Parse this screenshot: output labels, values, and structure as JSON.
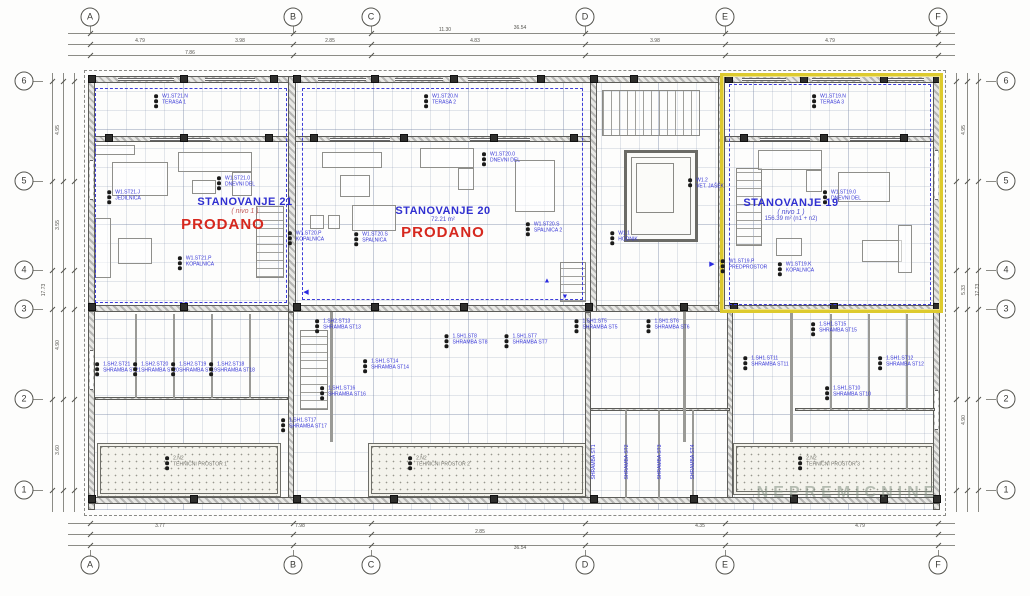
{
  "meta": {
    "watermark": "NEPREMICNINE"
  },
  "colors": {
    "blue": "#3434d6",
    "red": "#d6281e",
    "gray": "#76766e",
    "dim": "#55544e",
    "yellow": "#ddca2e"
  },
  "grid": {
    "columns": [
      {
        "label": "A",
        "x": 90
      },
      {
        "label": "B",
        "x": 293
      },
      {
        "label": "C",
        "x": 371
      },
      {
        "label": "D",
        "x": 585
      },
      {
        "label": "E",
        "x": 725
      },
      {
        "label": "F",
        "x": 938
      }
    ],
    "rows": [
      {
        "label": "6",
        "y": 81
      },
      {
        "label": "5",
        "y": 181
      },
      {
        "label": "4",
        "y": 270
      },
      {
        "label": "3",
        "y": 309
      },
      {
        "label": "2",
        "y": 399
      },
      {
        "label": "1",
        "y": 490
      }
    ]
  },
  "apartments": [
    {
      "name": "STANOVANJE 21",
      "level": "( nivo 1 )",
      "status": "PRODANO"
    },
    {
      "name": "STANOVANJE 20",
      "area": "72.21 m²",
      "status": "PRODANO"
    },
    {
      "name": "STANOVANJE 19",
      "level": "( nivo 1 )",
      "area": "156.39 m² (n1 + n2)"
    }
  ],
  "annotations": [
    [
      175,
      100,
      "W1.ST21.N|TERASA 1",
      "blue",
      5,
      0,
      3
    ],
    [
      445,
      100,
      "W1.ST20.N|TERASA 2",
      "blue",
      5,
      0,
      3
    ],
    [
      833,
      100,
      "W1.ST19.N|TERASA 3",
      "blue",
      5,
      0,
      3
    ],
    [
      240,
      182,
      "W1.ST21.0|DNEVNI DEL",
      "blue",
      5,
      0,
      3
    ],
    [
      128,
      196,
      "W1.ST21.J|JEDILNICA",
      "blue",
      5,
      0,
      3
    ],
    [
      505,
      158,
      "W1.ST20.0|DNEVNI DEL",
      "blue",
      5,
      0,
      3
    ],
    [
      846,
      196,
      "W1.ST19.0|DNEVNI DEL",
      "blue",
      5,
      0,
      3
    ],
    [
      200,
      262,
      "W1.ST21.P|KOPALNICA",
      "blue",
      5,
      0,
      3
    ],
    [
      310,
      237,
      "W1.ST20.P|KOPALNICA",
      "blue",
      5,
      0,
      3
    ],
    [
      375,
      238,
      "W1.ST20.S|SPALNICA",
      "blue",
      5,
      0,
      3
    ],
    [
      548,
      228,
      "W1.ST20.S|SPALNICA 2",
      "blue",
      5,
      0,
      3
    ],
    [
      748,
      265,
      "W1.ST19.P|PREDPROSTOR",
      "blue",
      5,
      0,
      3
    ],
    [
      800,
      268,
      "W1.ST19.K|KOPALNICA",
      "blue",
      5,
      0,
      3
    ],
    [
      628,
      237,
      "W1.1|HODNIK",
      "blue",
      5,
      0,
      3
    ],
    [
      710,
      184,
      "W1.2|VET. JAŠEK",
      "blue",
      5,
      0,
      2
    ],
    [
      122,
      368,
      "1.SH2.ST21|SHRAMBA ST21",
      "blue",
      5,
      0,
      3
    ],
    [
      160,
      368,
      "1.SH2.ST20|SHRAMBA ST20",
      "blue",
      5,
      0,
      3
    ],
    [
      198,
      368,
      "1.SH2.ST19|SHRAMBA ST19",
      "blue",
      5,
      0,
      3
    ],
    [
      236,
      368,
      "1.SH2.ST18|SHRAMBA ST18",
      "blue",
      5,
      0,
      3
    ],
    [
      342,
      325,
      "1.SH2.ST13|SHRAMBA ST13",
      "blue",
      5,
      0,
      3
    ],
    [
      390,
      365,
      "1.SH1.ST14|SHRAMBA ST14",
      "blue",
      5,
      0,
      3
    ],
    [
      347,
      392,
      "1.SH1.ST16|SHRAMBA ST16",
      "blue",
      5,
      0,
      3
    ],
    [
      308,
      424,
      "1.SH1.ST17|SHRAMBA ST17",
      "blue",
      5,
      0,
      3
    ],
    [
      470,
      340,
      "1.SH1.ST8|SHRAMBA ST8",
      "blue",
      5,
      0,
      3
    ],
    [
      530,
      340,
      "1.SH1.ST7|SHRAMBA ST7",
      "blue",
      5,
      0,
      3
    ],
    [
      600,
      325,
      "1.SH1.ST5|SHRAMBA ST5",
      "blue",
      5,
      0,
      3
    ],
    [
      672,
      325,
      "1.SH1.ST6|SHRAMBA ST6",
      "blue",
      5,
      0,
      3
    ],
    [
      595,
      462,
      "SHRAMBA ST1",
      "blue",
      5,
      -90,
      0
    ],
    [
      628,
      462,
      "SHRAMBA ST2",
      "blue",
      5,
      -90,
      0
    ],
    [
      661,
      462,
      "SHRAMBA ST3",
      "blue",
      5,
      -90,
      0
    ],
    [
      694,
      462,
      "SHRAMBA ST4",
      "blue",
      5,
      -90,
      0
    ],
    [
      838,
      328,
      "1.SH1.ST15|SHRAMBA ST15",
      "blue",
      5,
      0,
      3
    ],
    [
      770,
      362,
      "1.SH1.ST11|SHRAMBA ST11",
      "blue",
      5,
      0,
      3
    ],
    [
      905,
      362,
      "1.SH1.ST12|SHRAMBA ST12",
      "blue",
      5,
      0,
      3
    ],
    [
      852,
      392,
      "1.SH1.ST10|SHRAMBA ST10",
      "blue",
      5,
      0,
      3
    ],
    [
      200,
      462,
      "2.N2|TEHNIČNI PROSTOR 1",
      "gray",
      5,
      0,
      3
    ],
    [
      443,
      462,
      "2.N2|TEHNIČNI PROSTOR 2",
      "gray",
      5,
      0,
      3
    ],
    [
      833,
      462,
      "2.N2|TEHNIČNI PROSTOR 3",
      "gray",
      5,
      0,
      3
    ]
  ],
  "dimensions": [
    [
      140,
      41,
      "4.79",
      0
    ],
    [
      240,
      41,
      "3.98",
      0
    ],
    [
      330,
      41,
      "2.85",
      0
    ],
    [
      475,
      41,
      "4.83",
      0
    ],
    [
      655,
      41,
      "3.98",
      0
    ],
    [
      830,
      41,
      "4.79",
      0
    ],
    [
      190,
      53,
      "7.86",
      0
    ],
    [
      445,
      30,
      "11.30",
      0
    ],
    [
      520,
      28,
      "36.54",
      0
    ],
    [
      160,
      526,
      "3.77",
      0
    ],
    [
      300,
      526,
      "7.98",
      0
    ],
    [
      480,
      532,
      "2.85",
      0
    ],
    [
      700,
      526,
      "4.35",
      0
    ],
    [
      860,
      526,
      "4.79",
      0
    ],
    [
      520,
      548,
      "36.54",
      0
    ],
    [
      58,
      130,
      "4.95",
      -90
    ],
    [
      58,
      225,
      "3.55",
      -90
    ],
    [
      58,
      345,
      "4.90",
      -90
    ],
    [
      58,
      450,
      "3.60",
      -90
    ],
    [
      44,
      290,
      "17.73",
      -90
    ],
    [
      964,
      130,
      "4.95",
      -90
    ],
    [
      964,
      290,
      "5.33",
      -90
    ],
    [
      964,
      420,
      "4.90",
      -90
    ],
    [
      978,
      290,
      "17.73",
      -90
    ]
  ],
  "arrows": [
    [
      306,
      292,
      "◀"
    ],
    [
      547,
      281,
      "▲"
    ],
    [
      712,
      264,
      "▶"
    ],
    [
      565,
      297,
      "▼"
    ]
  ]
}
